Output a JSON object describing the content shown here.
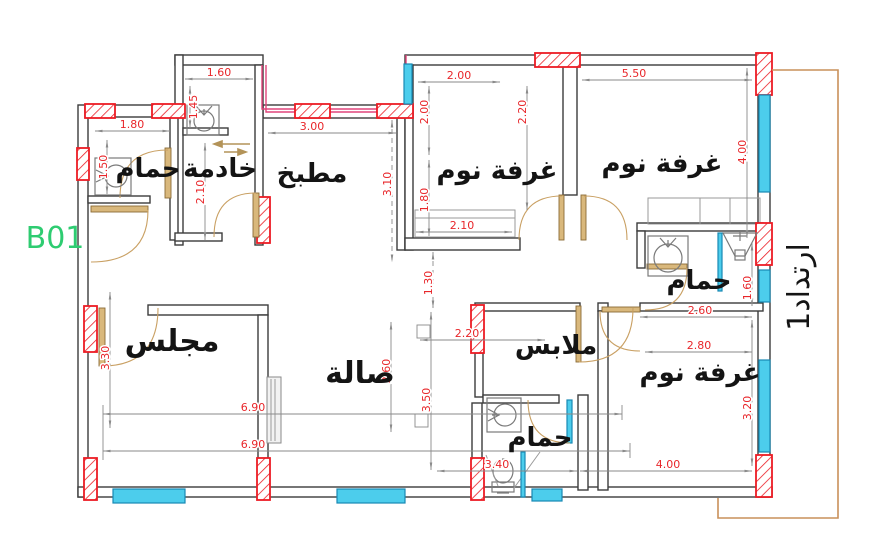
{
  "unit_label": "B01",
  "setback_label": "ارتداد1",
  "rooms": {
    "bath_top_left": "حمام",
    "maid": "خادمة",
    "kitchen": "مطبخ",
    "bedroom_top": "غرفة نوم",
    "bedroom_right": "غرفة نوم",
    "bath_right": "حمام",
    "bedroom_bottom_right": "غرفة نوم",
    "closet": "ملابس",
    "bath_bottom": "حمام",
    "hall": "صالة",
    "majlis": "مجلس"
  },
  "dims": {
    "bath_tl_width": "1.80",
    "bath_tl_height": "1.50",
    "maid_wc_width": "1.60",
    "maid_wc_height": "1.45",
    "maid_height": "2.10",
    "kitchen_width": "3.00",
    "kitchen_height": "3.10",
    "bed_top_win": "2.00",
    "bed_top_left_h": "2.00",
    "bed_top_right_h": "2.20",
    "bed_top_lower_h": "1.80",
    "bed_top_wardrobe": "2.10",
    "bed_right_width": "5.50",
    "bed_right_height": "4.00",
    "bath_right_height": "1.60",
    "bed_br_top": "2.60",
    "bed_br_mid": "2.80",
    "bed_br_height": "3.20",
    "bed_br_width": "4.00",
    "closet_width": "2.20",
    "corridor_gap": "1.30",
    "hall_a": "2.60",
    "hall_b": "3.50",
    "majlis_height": "3.30",
    "plan_width_a": "6.90",
    "plan_width_b": "6.90",
    "bath_bottom_width": "3.40"
  },
  "colors": {
    "wall": "#3c3c3c",
    "column_red": "#ec1c24",
    "window_cyan": "#4ccdec",
    "door_tan": "#c9a063",
    "dim_text_red": "#e8262a",
    "dim_line_gray": "#8a8a8a",
    "highlight_pink": "#e0457b",
    "boundary_tan": "#c9905a",
    "unit_green": "#2ecc71"
  }
}
